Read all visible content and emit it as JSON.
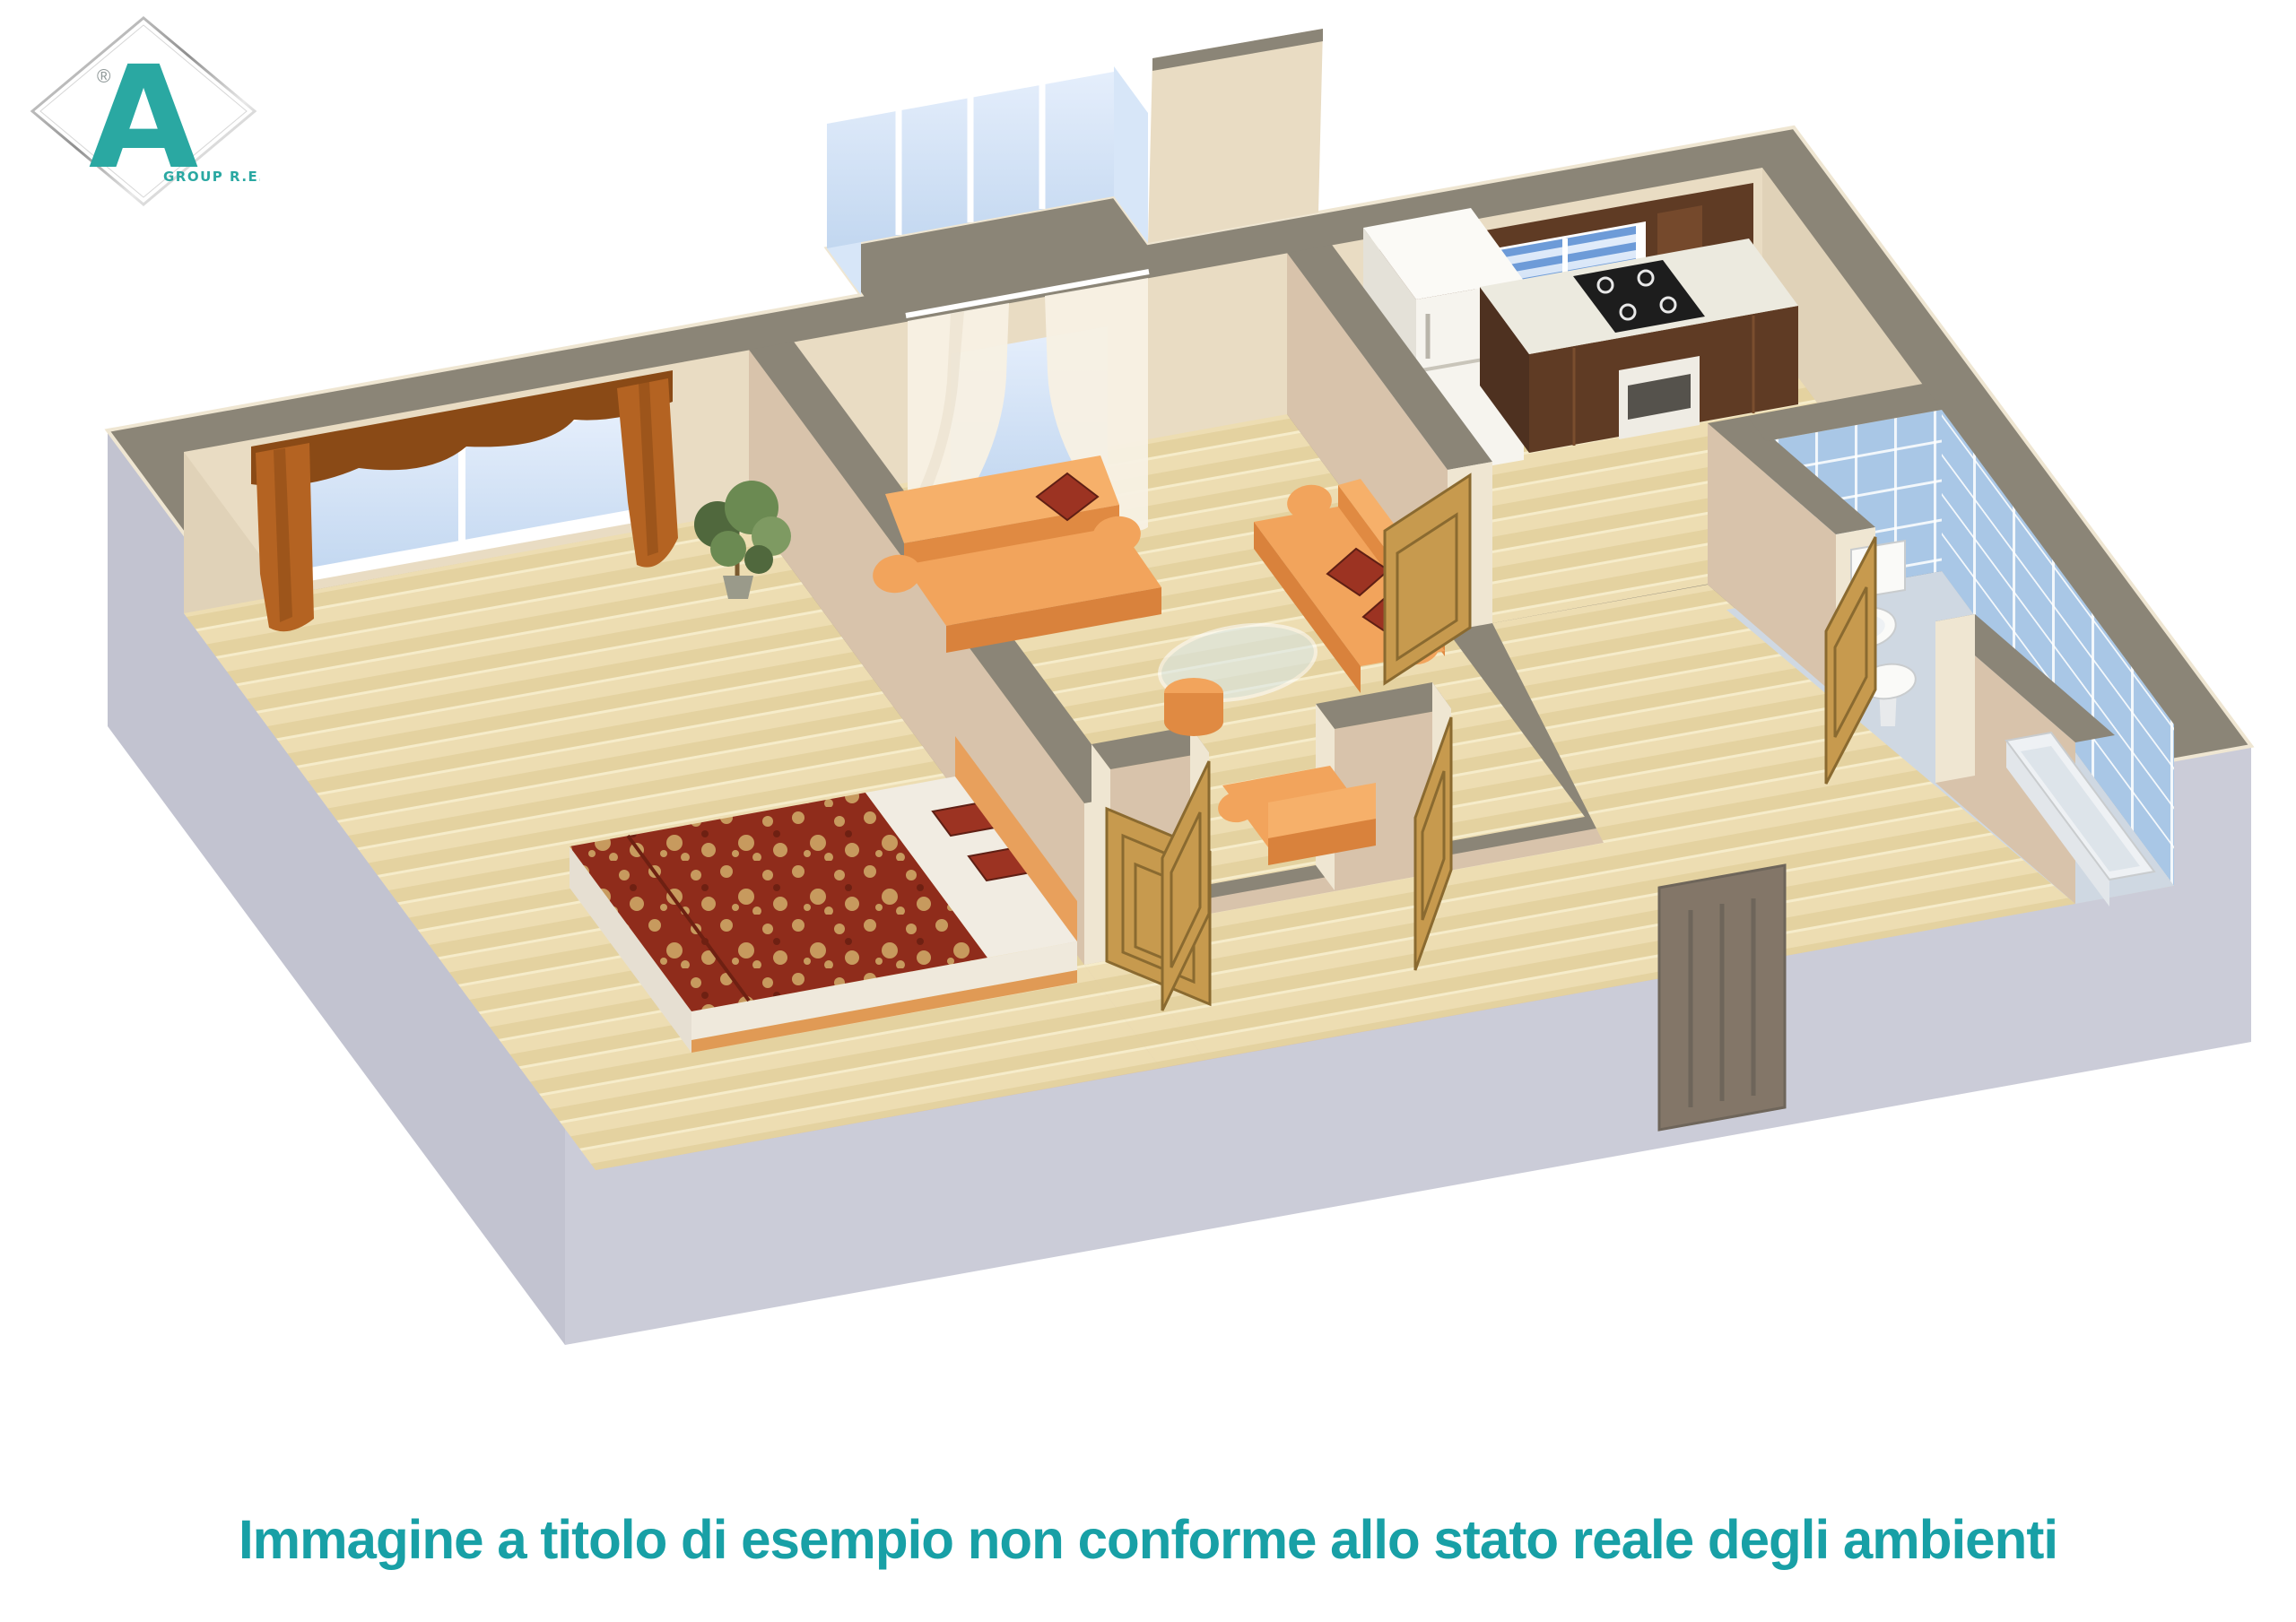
{
  "caption": {
    "text": "Immagine a titolo di esempio non conforme allo stato reale degli ambienti"
  },
  "logo": {
    "letter": "A",
    "subtext": "GROUP R.E.",
    "registered": "®"
  },
  "colors": {
    "accent": "#18a0a6",
    "logoteal": "#2aa8a2",
    "wallTop": "#8b8577",
    "wallCream": "#e9dcc3",
    "wallCream2": "#e0d2b8",
    "wallPink": "#d8c3ab",
    "capCream": "#efe6d2",
    "ext1": "#c2c3d0",
    "ext2": "#cbccd8",
    "ext3": "#c6c7d4",
    "floor1": "#edddb2",
    "floor2": "#e4d2a0",
    "bathFloor": "#cfd8e2",
    "tile": "#a9c7e6",
    "glass": "#d7e6f8",
    "blind": "#6d9bd8",
    "curtainRust1": "#b46322",
    "curtainRust2": "#8a4a16",
    "sheer": "#f7f0e3",
    "sofa1": "#f2a45c",
    "sofa2": "#e08a42",
    "sofa3": "#f6b06a",
    "sofa4": "#d9823c",
    "pillow": "#9c3322",
    "bedRed": "#8f2c1b",
    "bedTan": "#c79a5e",
    "linen": "#f1ece2",
    "headboard": "#e8a05c",
    "oak": "#c79a4e",
    "oakDark": "#8a6a30",
    "walnut": "#5f3b24",
    "walnutDark": "#4e3120",
    "walnutHi": "#7a4e2e",
    "counter": "#eceadf",
    "white": "#f6f4ee",
    "fridgeSide": "#e4e1d8",
    "entry": "#837668",
    "entryDark": "#6e655a",
    "plant1": "#50683d",
    "plant2": "#6b8a52",
    "plant3": "#7e9a62",
    "pot": "#9a9a8a"
  }
}
